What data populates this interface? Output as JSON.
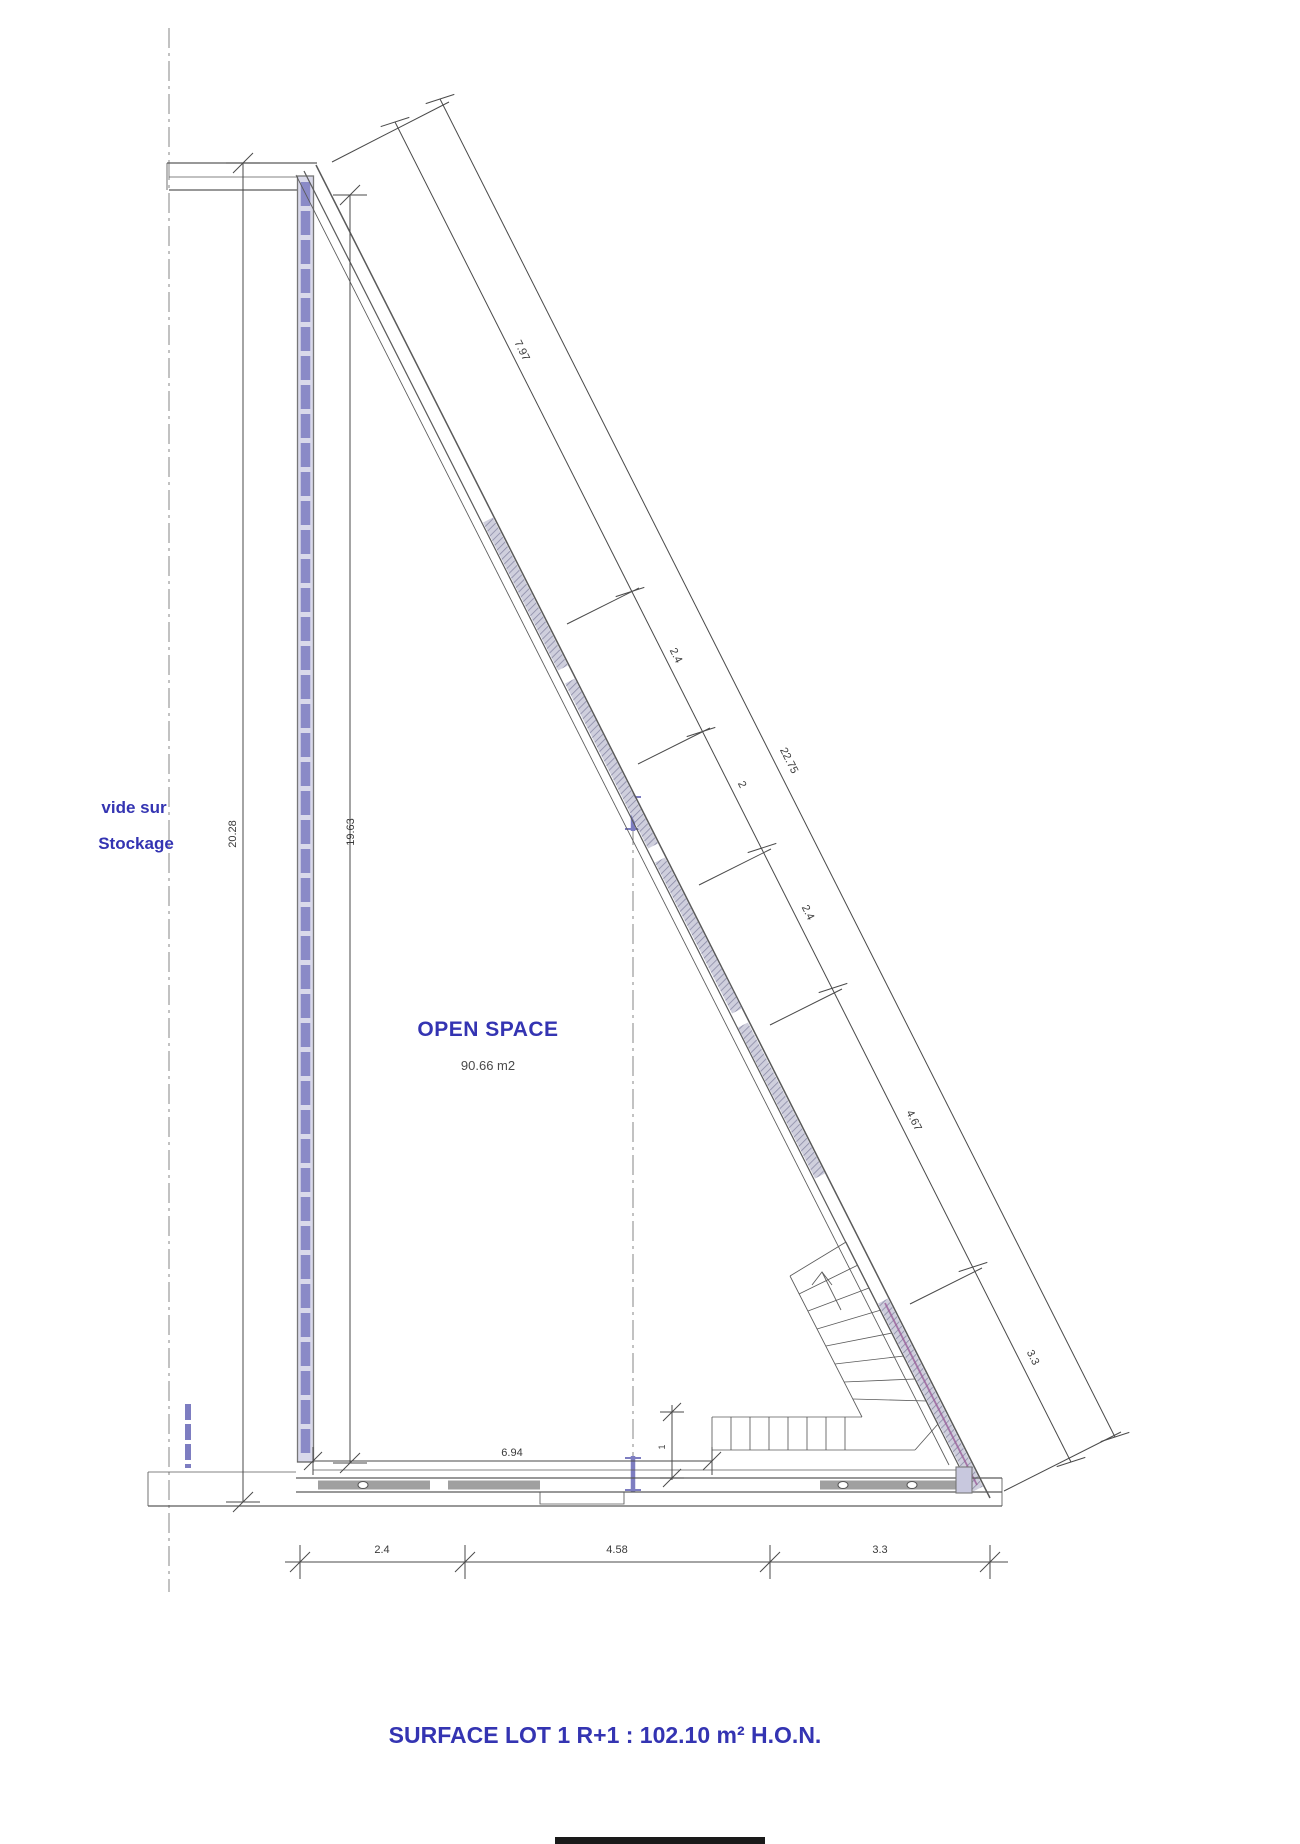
{
  "labels": {
    "void_line1": "vide sur",
    "void_line2": "Stockage",
    "open_space": "OPEN SPACE",
    "open_space_area": "90.66 m2",
    "surface_total": "SURFACE LOT 1 R+1  : 102.10 m² H.O.N."
  },
  "vertical_dims": {
    "outer": "20.28",
    "inner": "19.63"
  },
  "diagonal_dims": {
    "segments": [
      "7.97",
      "2.4",
      "2",
      "2.4",
      "4.67",
      "3.3"
    ],
    "total": "22.75"
  },
  "bottom_dims": {
    "segments": [
      "2.4",
      "4.58",
      "3.3"
    ],
    "inner": "6.94",
    "stair_offset": "1"
  },
  "colors": {
    "annotation_blue": "#3434b2",
    "line": "#5a5a5a",
    "glazing_purple": "#7d7dc1"
  }
}
